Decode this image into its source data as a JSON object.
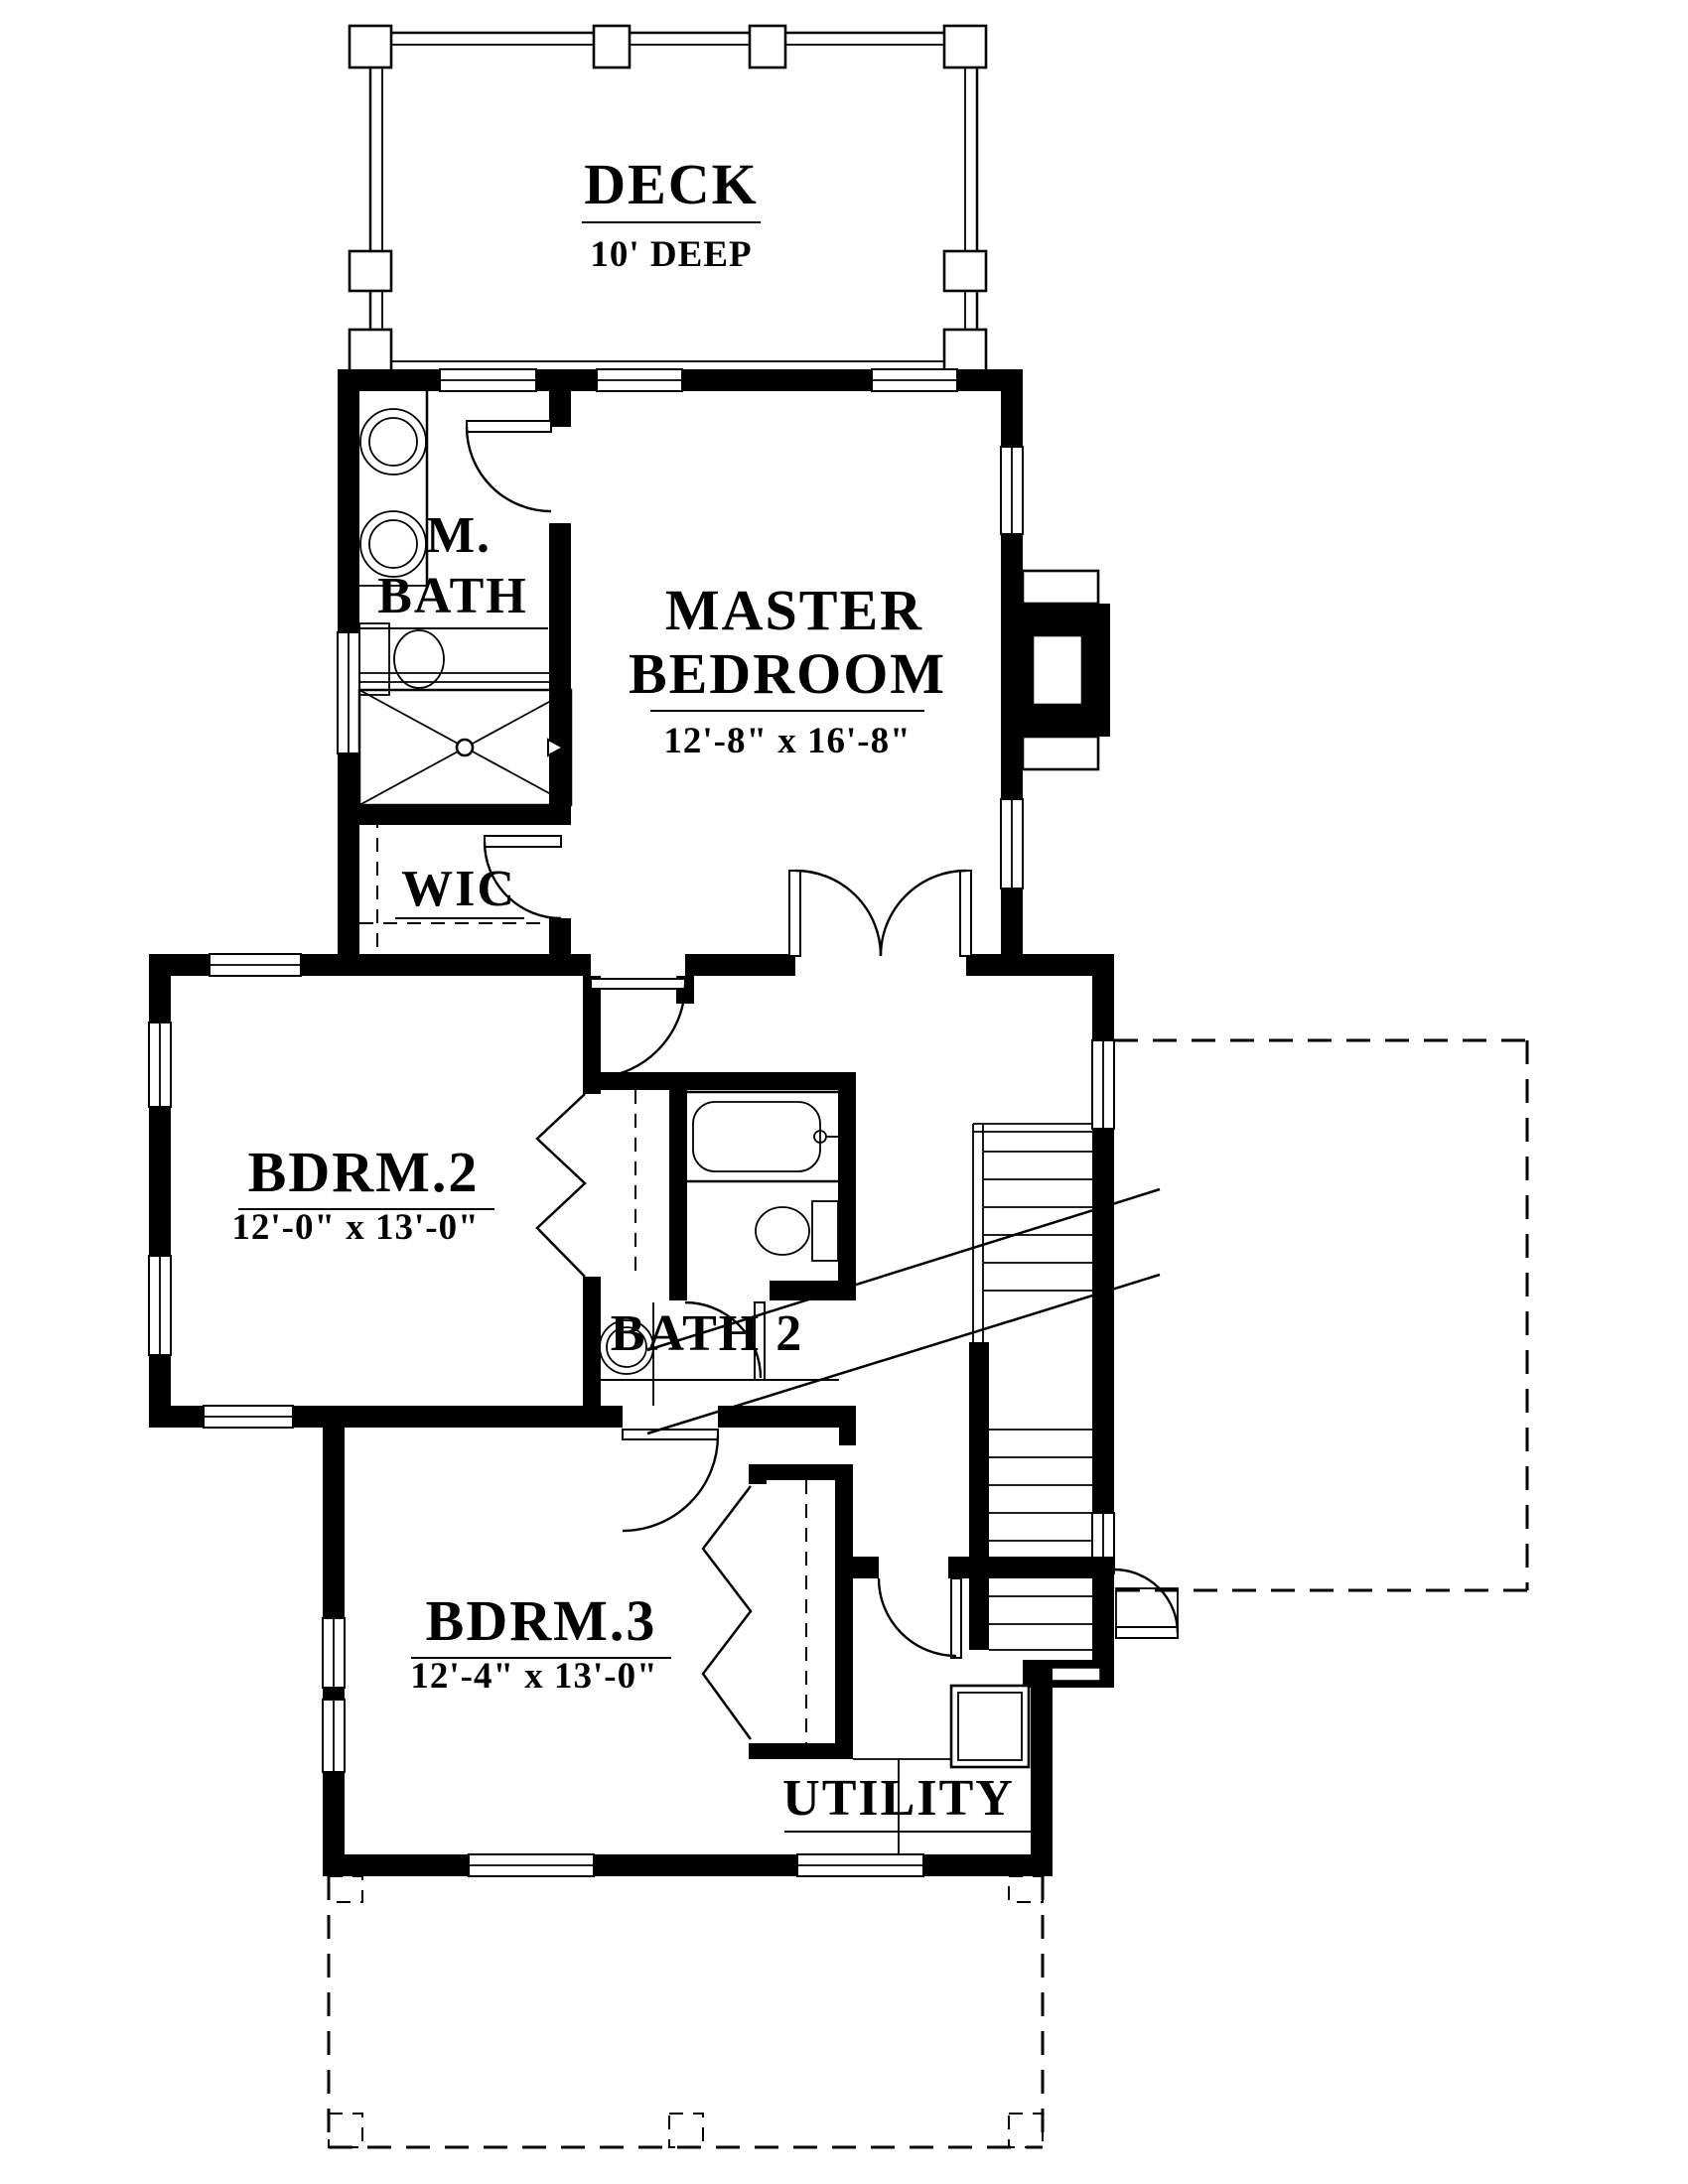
{
  "drawing": {
    "type": "floor-plan",
    "colors": {
      "wall": "#000000",
      "background": "#ffffff"
    }
  },
  "labels": {
    "deck": "DECK",
    "deck_dim": "10' DEEP",
    "mbath_line1": "M.",
    "mbath_line2": "BATH",
    "master_line1": "MASTER",
    "master_line2": "BEDROOM",
    "master_dim": "12'-8\" x 16'-8\"",
    "wic": "WIC",
    "bdrm2": "BDRM.2",
    "bdrm2_dim": "12'-0\" x 13'-0\"",
    "bath2": "BATH 2",
    "bdrm3": "BDRM.3",
    "bdrm3_dim": "12'-4\" x 13'-0\"",
    "utility": "UTILITY"
  }
}
